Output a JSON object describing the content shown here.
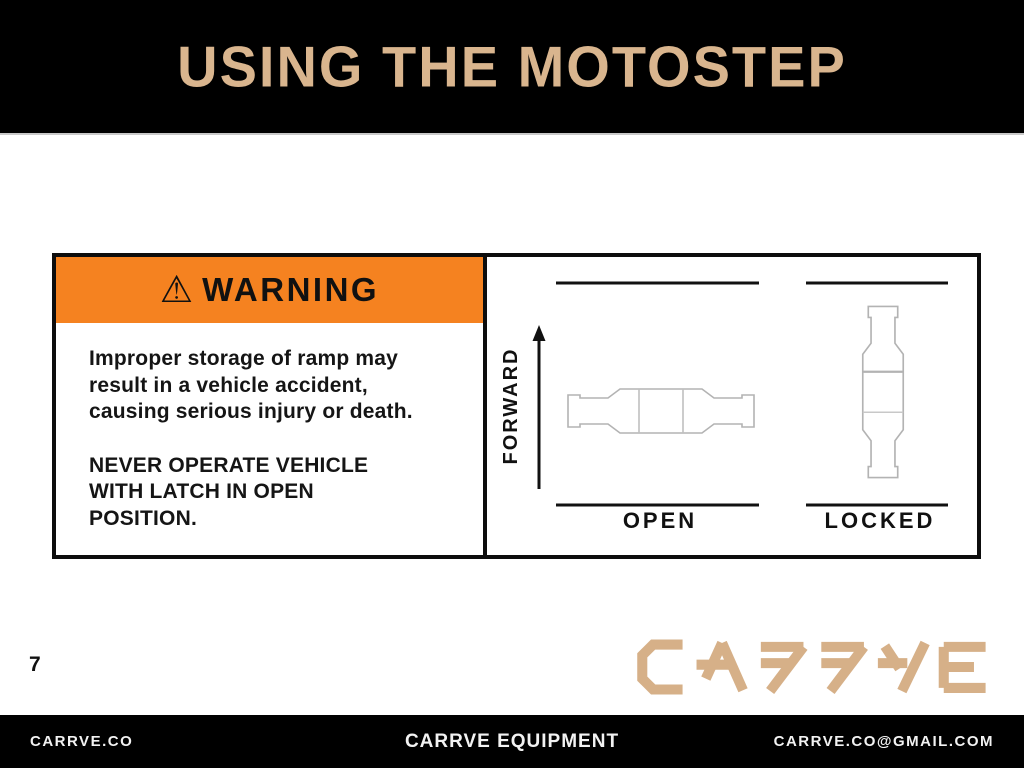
{
  "slide": {
    "title": "USING THE MOTOSTEP",
    "page_number": "7"
  },
  "warning_panel": {
    "warning_icon": "⚠",
    "heading": "WARNING",
    "paragraph_1_lines": [
      "Improper storage of ramp may",
      "result in a vehicle accident,",
      "causing serious injury or death."
    ],
    "paragraph_2_lines": [
      "NEVER OPERATE VEHICLE",
      "WITH LATCH IN OPEN",
      "POSITION."
    ]
  },
  "diagram_panel": {
    "direction_label": "FORWARD",
    "left_state_label": "OPEN",
    "right_state_label": "LOCKED"
  },
  "brand": {
    "logo_text": "CARRVE"
  },
  "footer": {
    "left_text": "CARRVE.CO",
    "center_text": "CARRVE EQUIPMENT",
    "right_text": "CARRVE.CO@GMAIL.COM"
  },
  "colors": {
    "header_background": "#000000",
    "title_tan": "#D9B58E",
    "warning_orange": "#F58220",
    "latch_outline_gray": "#B3B3B3",
    "logo_tan": "#D6B088",
    "footer_background": "#000000"
  }
}
